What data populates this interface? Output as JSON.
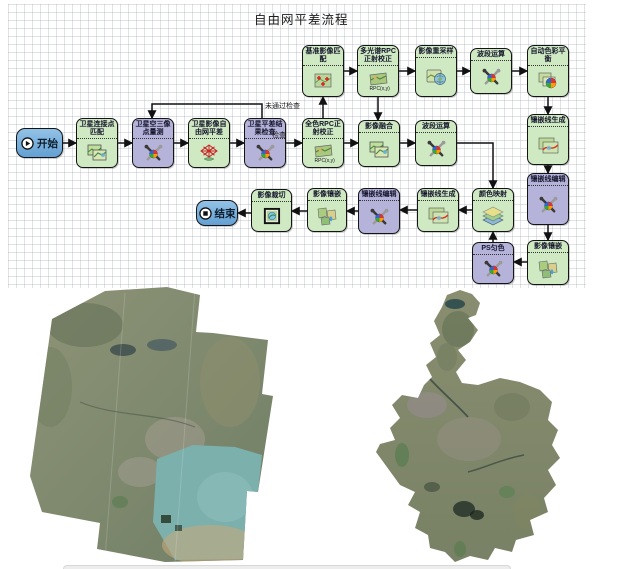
{
  "title": "自由网平差流程",
  "diagram": {
    "nodes": [
      {
        "id": "start",
        "label": "开始",
        "kind": "blue",
        "icon": "play",
        "x": 16,
        "y": 128,
        "w": 47,
        "h": 30
      },
      {
        "id": "tie-point-match",
        "label": "卫星连接点匹配",
        "kind": "green",
        "icon": "images",
        "x": 76,
        "y": 118,
        "w": 42,
        "h": 50
      },
      {
        "id": "sat-triangulation",
        "label": "卫星空三像点量测",
        "kind": "purple",
        "icon": "wrench",
        "x": 132,
        "y": 118,
        "w": 42,
        "h": 50
      },
      {
        "id": "free-net-adjust",
        "label": "卫星影像自由网平差",
        "kind": "green",
        "icon": "net",
        "x": 188,
        "y": 118,
        "w": 42,
        "h": 50
      },
      {
        "id": "adjust-check",
        "label": "卫星平差结果检查",
        "kind": "purple",
        "icon": "wrench",
        "x": 244,
        "y": 118,
        "w": 42,
        "h": 50
      },
      {
        "id": "pan-rpc-ortho",
        "label": "全色RPC正射校正",
        "kind": "green",
        "icon": "rpc",
        "x": 302,
        "y": 118,
        "w": 42,
        "h": 50
      },
      {
        "id": "base-image-match",
        "label": "基准影像匹配",
        "kind": "green",
        "icon": "match",
        "x": 302,
        "y": 45,
        "w": 42,
        "h": 52
      },
      {
        "id": "ms-rpc-ortho",
        "label": "多光谱RPC正射校正",
        "kind": "green",
        "icon": "rpc",
        "x": 357,
        "y": 45,
        "w": 42,
        "h": 52
      },
      {
        "id": "resample",
        "label": "影像重采样",
        "kind": "green",
        "icon": "globe",
        "x": 415,
        "y": 45,
        "w": 42,
        "h": 52
      },
      {
        "id": "band-calc-top",
        "label": "波段运算",
        "kind": "green",
        "icon": "wrench",
        "x": 470,
        "y": 48,
        "w": 42,
        "h": 46
      },
      {
        "id": "auto-color-balance",
        "label": "自动色彩平衡",
        "kind": "green",
        "icon": "photos-color",
        "x": 527,
        "y": 45,
        "w": 42,
        "h": 52
      },
      {
        "id": "fusion",
        "label": "影像融合",
        "kind": "green",
        "icon": "images",
        "x": 358,
        "y": 120,
        "w": 42,
        "h": 47
      },
      {
        "id": "band-calc-mid",
        "label": "波段运算",
        "kind": "green",
        "icon": "wrench",
        "x": 415,
        "y": 120,
        "w": 42,
        "h": 46
      },
      {
        "id": "mosaic-line-gen-r",
        "label": "镶嵌线生成",
        "kind": "green",
        "icon": "curve",
        "x": 527,
        "y": 114,
        "w": 42,
        "h": 51
      },
      {
        "id": "mosaic-line-edit-r",
        "label": "镶嵌线编辑",
        "kind": "purple",
        "icon": "wrench",
        "x": 527,
        "y": 173,
        "w": 42,
        "h": 52
      },
      {
        "id": "image-mosaic-r",
        "label": "影像镶嵌",
        "kind": "green",
        "icon": "mosaic",
        "x": 527,
        "y": 240,
        "w": 42,
        "h": 45
      },
      {
        "id": "color-map",
        "label": "颜色映射",
        "kind": "green",
        "icon": "layers",
        "x": 472,
        "y": 188,
        "w": 42,
        "h": 44
      },
      {
        "id": "ps-uniform-color",
        "label": "PS匀色",
        "kind": "purple",
        "icon": "wrench",
        "x": 472,
        "y": 242,
        "w": 42,
        "h": 42
      },
      {
        "id": "mosaic-line-gen-b",
        "label": "镶嵌线生成",
        "kind": "green",
        "icon": "curve",
        "x": 417,
        "y": 188,
        "w": 42,
        "h": 44
      },
      {
        "id": "mosaic-line-edit-b",
        "label": "镶嵌线编辑",
        "kind": "purple",
        "icon": "wrench",
        "x": 358,
        "y": 188,
        "w": 42,
        "h": 46
      },
      {
        "id": "image-mosaic-b",
        "label": "影像镶嵌",
        "kind": "green",
        "icon": "mosaic",
        "x": 307,
        "y": 188,
        "w": 40,
        "h": 44
      },
      {
        "id": "image-crop",
        "label": "影像裁切",
        "kind": "green",
        "icon": "crop",
        "x": 251,
        "y": 189,
        "w": 41,
        "h": 43
      },
      {
        "id": "end",
        "label": "结束",
        "kind": "blue",
        "icon": "stop",
        "x": 196,
        "y": 200,
        "w": 42,
        "h": 26
      }
    ],
    "edges": [
      {
        "points": [
          [
            63,
            143
          ],
          [
            76,
            143
          ]
        ]
      },
      {
        "points": [
          [
            118,
            143
          ],
          [
            132,
            143
          ]
        ]
      },
      {
        "points": [
          [
            174,
            143
          ],
          [
            188,
            143
          ]
        ]
      },
      {
        "points": [
          [
            230,
            143
          ],
          [
            244,
            143
          ]
        ]
      },
      {
        "points": [
          [
            286,
            143
          ],
          [
            302,
            143
          ]
        ],
        "label": "检查",
        "label_x": 272,
        "label_y": 132
      },
      {
        "points": [
          [
            262,
            118
          ],
          [
            262,
            104
          ],
          [
            152,
            104
          ],
          [
            152,
            118
          ]
        ],
        "label": "未通过检查",
        "label_x": 265,
        "label_y": 103
      },
      {
        "points": [
          [
            323,
            118
          ],
          [
            323,
            97
          ]
        ]
      },
      {
        "points": [
          [
            344,
            71
          ],
          [
            357,
            71
          ]
        ]
      },
      {
        "points": [
          [
            399,
            71
          ],
          [
            415,
            71
          ]
        ]
      },
      {
        "points": [
          [
            457,
            71
          ],
          [
            470,
            71
          ]
        ]
      },
      {
        "points": [
          [
            512,
            71
          ],
          [
            527,
            71
          ]
        ]
      },
      {
        "points": [
          [
            378,
            97
          ],
          [
            378,
            120
          ]
        ]
      },
      {
        "points": [
          [
            344,
            143
          ],
          [
            358,
            143
          ]
        ]
      },
      {
        "points": [
          [
            400,
            143
          ],
          [
            415,
            143
          ]
        ]
      },
      {
        "points": [
          [
            457,
            143
          ],
          [
            493,
            143
          ],
          [
            493,
            188
          ]
        ]
      },
      {
        "points": [
          [
            548,
            97
          ],
          [
            548,
            114
          ]
        ]
      },
      {
        "points": [
          [
            548,
            165
          ],
          [
            548,
            173
          ]
        ]
      },
      {
        "points": [
          [
            548,
            225
          ],
          [
            548,
            240
          ]
        ]
      },
      {
        "points": [
          [
            527,
            262
          ],
          [
            514,
            262
          ]
        ]
      },
      {
        "points": [
          [
            493,
            242
          ],
          [
            493,
            232
          ]
        ]
      },
      {
        "points": [
          [
            472,
            210
          ],
          [
            459,
            210
          ]
        ]
      },
      {
        "points": [
          [
            417,
            210
          ],
          [
            400,
            210
          ]
        ]
      },
      {
        "points": [
          [
            358,
            211
          ],
          [
            347,
            211
          ]
        ]
      },
      {
        "points": [
          [
            307,
            211
          ],
          [
            292,
            211
          ]
        ]
      },
      {
        "points": [
          [
            251,
            213
          ],
          [
            238,
            213
          ]
        ]
      }
    ]
  },
  "previews": {
    "left": "satellite-image-mosaic",
    "right": "satellite-image-region-clip"
  }
}
